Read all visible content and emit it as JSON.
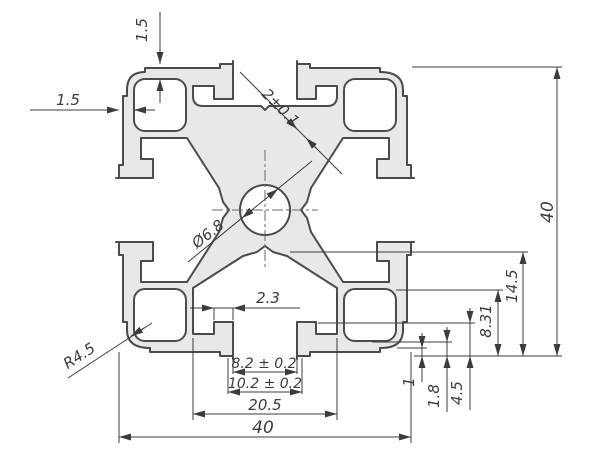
{
  "drawing": {
    "type": "technical-cross-section",
    "labels": {
      "overall_width": "40",
      "overall_height": "40",
      "slot_cavity_width": "20.5",
      "slot_chamfer_width": "10.2 ± 0.2",
      "slot_opening_width": "8.2 ± 0.2",
      "lip_offset": "2.3",
      "slot_depth": "14.5",
      "chamber_height": "8.31",
      "lip_height": "4.5",
      "bottom_wall": "1.8",
      "corner_step": "1",
      "top_wall": "1.5",
      "side_wall": "1.5",
      "nib_thickness": "2±0.1",
      "bore_diameter": "Ø6.8",
      "corner_radius": "R4.5"
    },
    "colors": {
      "body_fill": "#e8e8e8",
      "outline": "#4b4b4b",
      "dimension": "#3c3c3c",
      "centerline": "#6a6a6a",
      "background": "#ffffff"
    }
  }
}
